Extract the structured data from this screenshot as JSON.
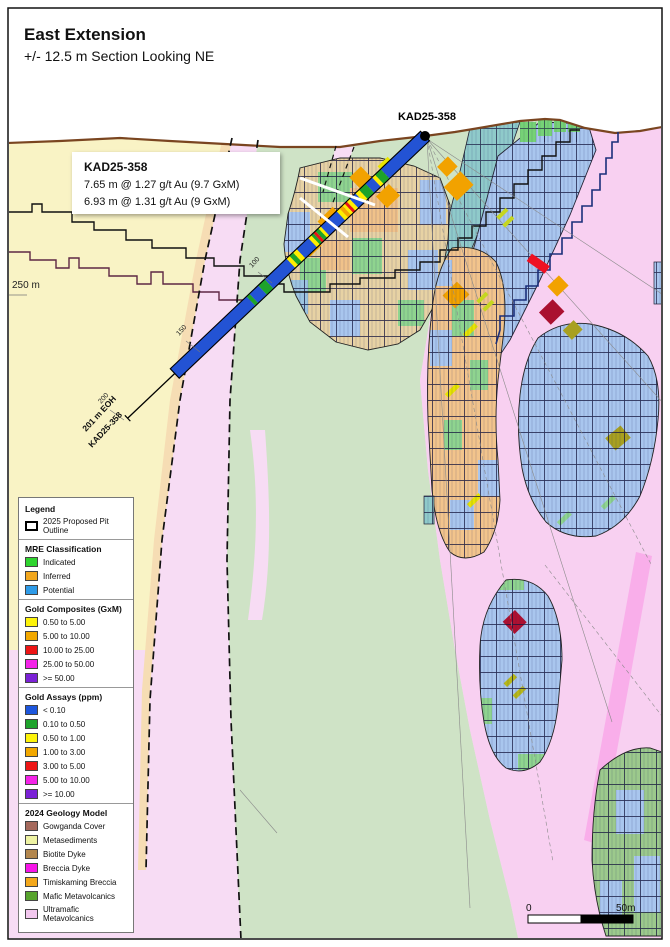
{
  "title": {
    "main": "East Extension",
    "subtitle": "+/- 12.5 m Section Looking NE"
  },
  "drill": {
    "collar_label": "KAD25-358",
    "eoh_label_line1": "201 m EOH",
    "eoh_label_line2": "KAD25-358",
    "depth_labels": [
      "100",
      "150",
      "200"
    ],
    "elevation_label": "250 m",
    "palette": {
      "B": "#2353d4",
      "G": "#1ea32a",
      "Y": "#ffee00",
      "O": "#f5a500",
      "R": "#e81515"
    },
    "intervals": [
      [
        "B",
        55
      ],
      [
        "G",
        8
      ],
      [
        "Y",
        4
      ],
      [
        "B",
        9
      ],
      [
        "G",
        9
      ],
      [
        "Y",
        5
      ],
      [
        "B",
        8
      ],
      [
        "Y",
        4
      ],
      [
        "R",
        3
      ],
      [
        "Y",
        3
      ],
      [
        "O",
        4
      ],
      [
        "Y",
        4
      ],
      [
        "B",
        22
      ],
      [
        "Y",
        3
      ],
      [
        "G",
        4
      ],
      [
        "R",
        3
      ],
      [
        "G",
        3
      ],
      [
        "Y",
        4
      ],
      [
        "B",
        16
      ],
      [
        "Y",
        5
      ],
      [
        "G",
        5
      ],
      [
        "Y",
        4
      ],
      [
        "B",
        30
      ],
      [
        "G",
        9
      ],
      [
        "B",
        12
      ],
      [
        "G",
        4
      ],
      [
        "B",
        105
      ]
    ]
  },
  "callout": {
    "title": "KAD25-358",
    "lines": [
      "7.65 m @ 1.27 g/t Au (9.7 GxM)",
      "6.93 m @ 1.31 g/t Au (9 GxM)"
    ]
  },
  "legend": {
    "sections": [
      {
        "title": "Legend",
        "items": [
          {
            "label": "2025 Proposed Pit Outline",
            "color": "#ffffff"
          }
        ]
      },
      {
        "title": "MRE Classification",
        "items": [
          {
            "label": "Indicated",
            "color": "#2fd42f"
          },
          {
            "label": "Inferred",
            "color": "#f2a71e"
          },
          {
            "label": "Potential",
            "color": "#2e9be8"
          }
        ]
      },
      {
        "title": "Gold Composites (GxM)",
        "items": [
          {
            "label": "0.50 to 5.00",
            "color": "#fdf30a"
          },
          {
            "label": "5.00 to 10.00",
            "color": "#f2a800"
          },
          {
            "label": "10.00 to 25.00",
            "color": "#ed1515"
          },
          {
            "label": "25.00 to 50.00",
            "color": "#f424e8"
          },
          {
            "label": ">= 50.00",
            "color": "#7b22d6"
          }
        ]
      },
      {
        "title": "Gold Assays (ppm)",
        "items": [
          {
            "label": "< 0.10",
            "color": "#1d56dd"
          },
          {
            "label": "0.10 to 0.50",
            "color": "#1fa32c"
          },
          {
            "label": "0.50 to 1.00",
            "color": "#fdf30a"
          },
          {
            "label": "1.00 to 3.00",
            "color": "#f2a800"
          },
          {
            "label": "3.00 to 5.00",
            "color": "#ed1515"
          },
          {
            "label": "5.00 to 10.00",
            "color": "#f424e8"
          },
          {
            "label": ">= 10.00",
            "color": "#7b22d6"
          }
        ]
      },
      {
        "title": "2024 Geology Model",
        "items": [
          {
            "label": "Gowganda Cover",
            "color": "#a5695c"
          },
          {
            "label": "Metasediments",
            "color": "#eef3a3"
          },
          {
            "label": "Biotite Dyke",
            "color": "#b3874e"
          },
          {
            "label": "Breccia Dyke",
            "color": "#f715e8"
          },
          {
            "label": "Timiskaming Breccia",
            "color": "#f3a81c"
          },
          {
            "label": "Mafic Metavolcanics",
            "color": "#58a42e"
          },
          {
            "label": "Ultramafic Metavolcanics",
            "color": "#f2c7ee"
          }
        ]
      }
    ]
  },
  "scalebar": {
    "left": "0",
    "right": "50m"
  }
}
